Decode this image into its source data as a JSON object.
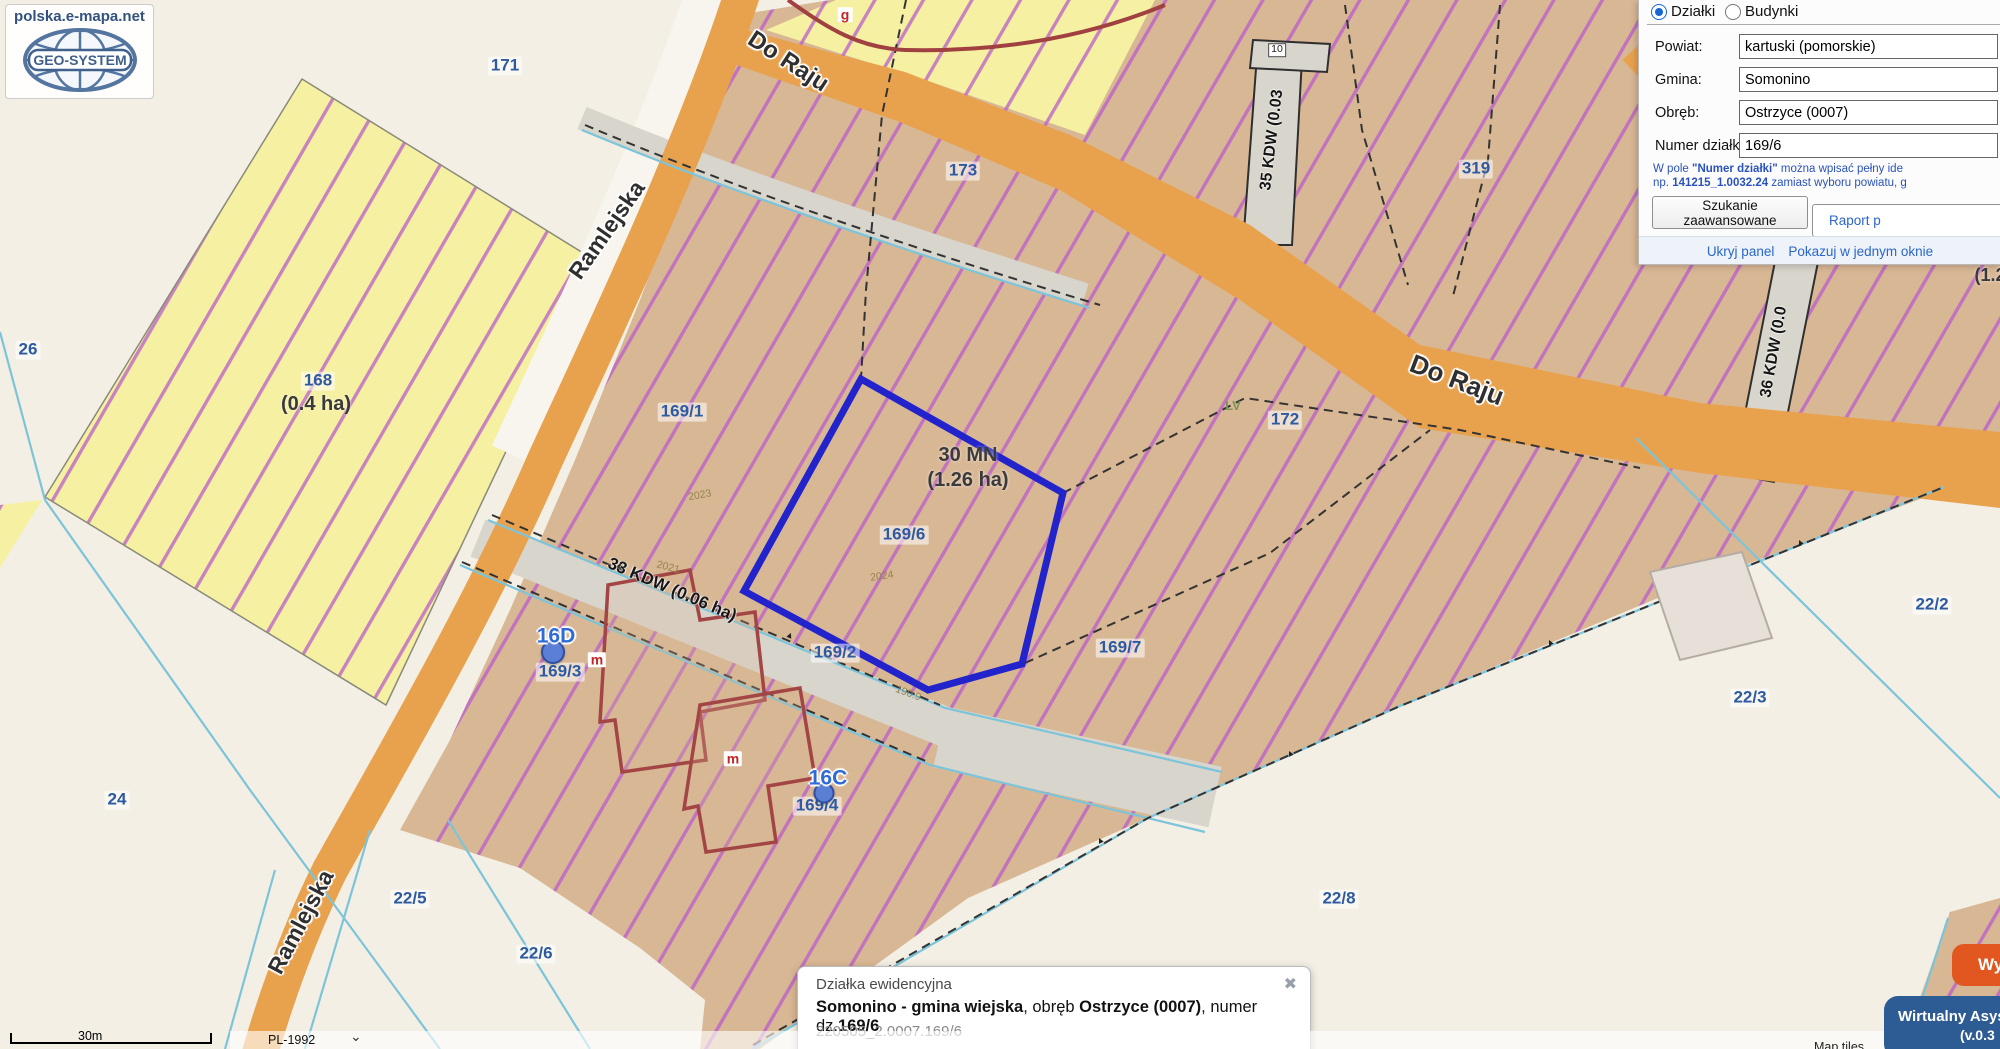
{
  "site": {
    "name": "polska.e-mapa.net",
    "brand": "GEO-SYSTEM"
  },
  "search_panel": {
    "layer_options": [
      {
        "label": "Działki",
        "selected": true
      },
      {
        "label": "Budynki",
        "selected": false
      }
    ],
    "fields": [
      {
        "label": "Powiat:",
        "value": "kartuski (pomorskie)"
      },
      {
        "label": "Gmina:",
        "value": "Somonino"
      },
      {
        "label": "Obręb:",
        "value": "Ostrzyce (0007)"
      },
      {
        "label": "Numer działki:",
        "value": "169/6"
      }
    ],
    "help": {
      "seg1": "W pole ",
      "seg2": "\"Numer działki\"",
      "seg3": " można wpisać pełny ide",
      "seg4": "np. ",
      "seg5": "141215_1.0032.24",
      "seg6": " zamiast wyboru powiatu, g"
    },
    "advanced_button": "Szukanie zaawansowane",
    "report_button": "Raport p",
    "hide_link": "Ukryj panel",
    "single_window_link": "Pokazuj w jednym oknie"
  },
  "info_popup": {
    "title": "Działka ewidencyjna",
    "close_icon": "✖",
    "line": {
      "b1": "Somonino - gmina wiejska",
      "n1": ", obręb ",
      "b2": "Ostrzyce (0007)",
      "n2": ", numer dz.",
      "b3": "169/6"
    },
    "identifier": "220505_2.0007.169/6"
  },
  "map": {
    "street_labels": [
      "Do Raju",
      "Do Raju",
      "Ramlejska",
      "Ramlejska"
    ],
    "parcel_labels": [
      "171",
      "26",
      "24",
      "168",
      "169/1",
      "169/6",
      "169/2",
      "169/7",
      "169/3",
      "169/4",
      "172",
      "173",
      "319",
      "22/2",
      "22/3",
      "22/5",
      "22/6",
      "22/8"
    ],
    "zone_labels": [
      "30 MN",
      "(1.26 ha)",
      "(0.4 ha)",
      "(1.2"
    ],
    "road_zone_labels": [
      "33 KDW (0.06 ha)",
      "35 KDW (0.03",
      "36 KDW (0.0"
    ],
    "address_labels": [
      "16D",
      "16C"
    ],
    "marker_labels": [
      "m",
      "m",
      "g"
    ],
    "survey_texts": [
      "2023",
      "2024",
      "2021",
      "190.9",
      "10",
      "LV"
    ]
  },
  "map_controls": {
    "scale_label": "30m",
    "crs_selector": "PL-1992",
    "attribution": "Map tiles"
  },
  "overlay_widgets": {
    "assistant_title": "Wirtualny Asys",
    "assistant_version": "(v.0.3",
    "action_button": "Wy"
  },
  "colors": {
    "parcel_highlight": "#2323cc",
    "road_fill": "#e8a24e",
    "hatch_line": "#bd68c5",
    "zone_tan": "#d8b794",
    "zone_yellow": "#f5f0a2",
    "accent_blue": "#2d5aa0",
    "assistant_bg": "#2d5c94",
    "action_orange": "#e2571f"
  }
}
